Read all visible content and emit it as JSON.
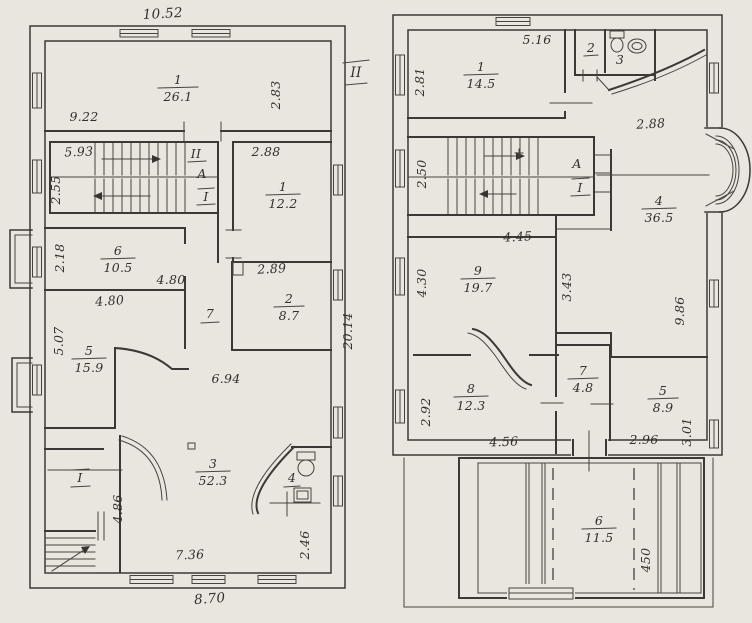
{
  "colors": {
    "paper": "#e9e6e0",
    "ink": "#37332e"
  },
  "left_plan": {
    "rooms": {
      "r1": {
        "num": "1",
        "area": "26.1"
      },
      "r1b": {
        "num": "1",
        "area": "12.2"
      },
      "r6": {
        "num": "6",
        "area": "10.5"
      },
      "r2": {
        "num": "2",
        "area": "8.7"
      },
      "r5": {
        "num": "5",
        "area": "15.9"
      },
      "r3": {
        "num": "3",
        "area": "52.3"
      },
      "r4": {
        "num": "4"
      },
      "r7": {
        "num": "7"
      }
    },
    "dims": {
      "top": "10.52",
      "w922": "9.22",
      "v283": "2.83",
      "w593": "5.93",
      "v255": "2.55",
      "w288": "2.88",
      "v218": "2.18",
      "w480a": "4.80",
      "w480b": "4.80",
      "w289": "2.89",
      "v2014": "20.14",
      "v507": "5.07",
      "w694": "6.94",
      "v486": "4.86",
      "v246": "2.46",
      "w736": "7.36",
      "w870": "8.70"
    },
    "markers": {
      "section": "II",
      "flight": "II",
      "axis_a": "А",
      "axis_1": "I",
      "entry": "I"
    }
  },
  "right_plan": {
    "rooms": {
      "r1": {
        "num": "1",
        "area": "14.5"
      },
      "r2": {
        "num": "2"
      },
      "r3": {
        "num": "3"
      },
      "r4": {
        "num": "4",
        "area": "36.5"
      },
      "r9": {
        "num": "9",
        "area": "19.7"
      },
      "r8": {
        "num": "8",
        "area": "12.3"
      },
      "r7": {
        "num": "7",
        "area": "4.8"
      },
      "r5": {
        "num": "5",
        "area": "8.9"
      },
      "r6": {
        "num": "6",
        "area": "11.5"
      }
    },
    "dims": {
      "w516": "5.16",
      "v281": "2.81",
      "w288": "2.88",
      "v250": "2.50",
      "w445": "4.45",
      "v430": "4.30",
      "v343": "3.43",
      "v986": "9.86",
      "v292": "2.92",
      "w456": "4.56",
      "w296": "2.96",
      "v301": "3.01",
      "v450": "450"
    },
    "markers": {
      "axis_a": "А",
      "axis_1": "I"
    }
  }
}
